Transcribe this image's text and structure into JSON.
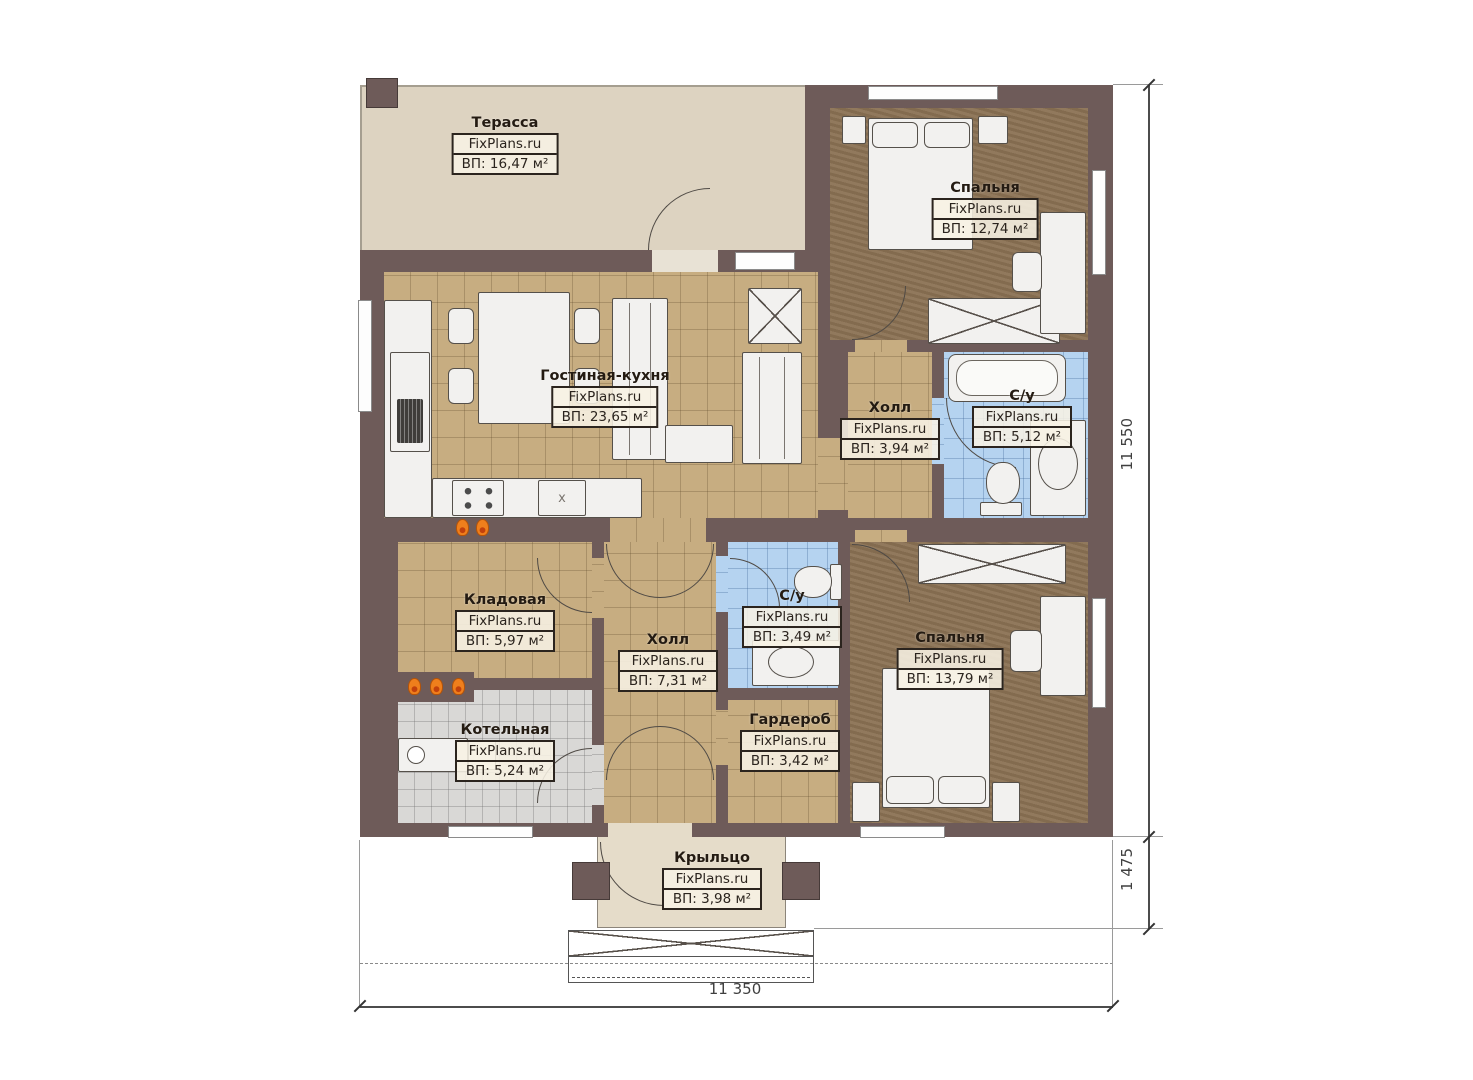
{
  "branding": {
    "watermark": "FixPlans.ru"
  },
  "rooms": [
    {
      "id": "terrace",
      "name": "Терасса",
      "area": "ВП: 16,47 м²"
    },
    {
      "id": "bedroom-top",
      "name": "Спальня",
      "area": "ВП: 12,74 м²"
    },
    {
      "id": "living-kitchen",
      "name": "Гостиная-кухня",
      "area": "ВП: 23,65 м²"
    },
    {
      "id": "hall-right",
      "name": "Холл",
      "area": "ВП: 3,94 м²"
    },
    {
      "id": "bathroom-top",
      "name": "С/у",
      "area": "ВП: 5,12 м²"
    },
    {
      "id": "storage",
      "name": "Кладовая",
      "area": "ВП: 5,97 м²"
    },
    {
      "id": "hall-center",
      "name": "Холл",
      "area": "ВП: 7,31 м²"
    },
    {
      "id": "bathroom-center",
      "name": "С/у",
      "area": "ВП: 3,49 м²"
    },
    {
      "id": "boiler",
      "name": "Котельная",
      "area": "ВП: 5,24 м²"
    },
    {
      "id": "wardrobe",
      "name": "Гардероб",
      "area": "ВП: 3,42 м²"
    },
    {
      "id": "bedroom-bottom",
      "name": "Спальня",
      "area": "ВП: 13,79 м²"
    },
    {
      "id": "porch",
      "name": "Крыльцо",
      "area": "ВП: 3,98 м²"
    }
  ],
  "dimensions": {
    "right_total": "11 550",
    "right_porch": "1 475",
    "bottom_total": "11 350"
  },
  "appliances": {
    "dishwasher_label": "x"
  },
  "colors": {
    "wall": "#6e5b59",
    "floor_tile_tan": "#c7ad81",
    "floor_tile_blue": "#b5d3f0",
    "floor_tile_grey": "#d9d8d6",
    "floor_wood": "#8b7254",
    "terrace": "#ddd3c1",
    "porch": "#e5dcc9",
    "flame_accent": "#ef7f1c"
  }
}
